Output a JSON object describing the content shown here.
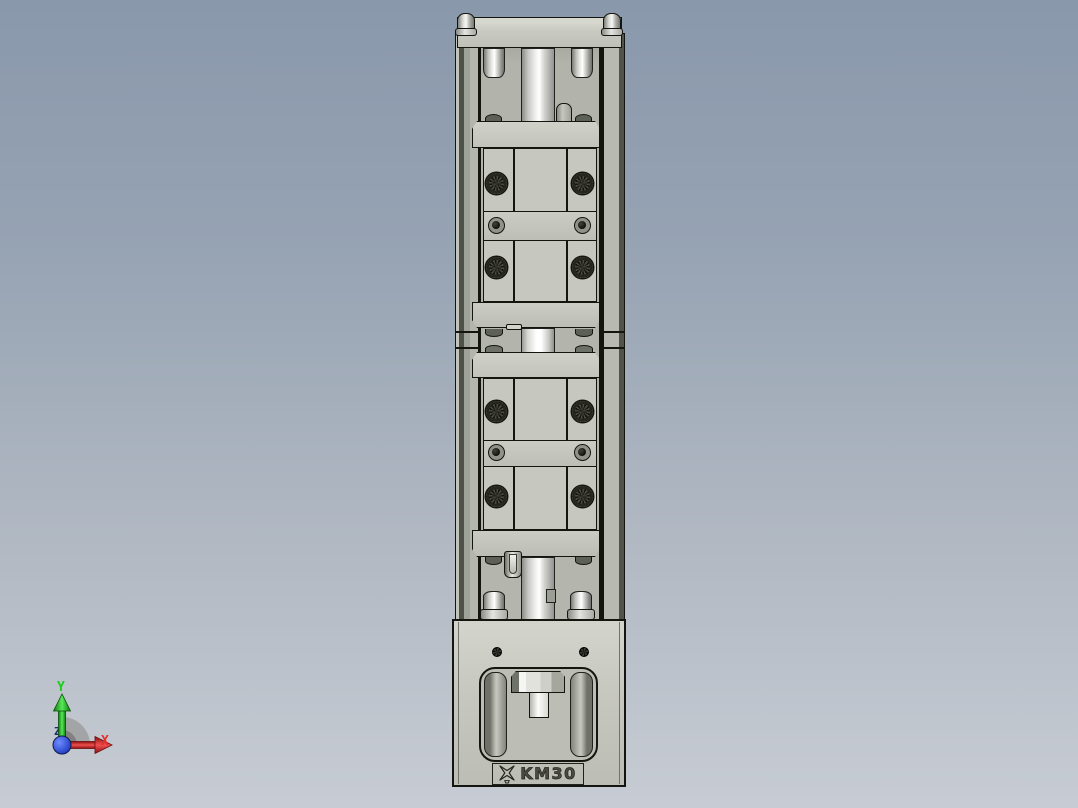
{
  "viewport": {
    "type": "3d-cad-view",
    "background_gradient_top": "#8A98AC",
    "background_gradient_bottom": "#C7CCD4"
  },
  "triad": {
    "y_label": "Y",
    "x_label": "X",
    "z_label": "Z",
    "y_color": "#17CF17",
    "x_color": "#E3302C",
    "z_color": "#1C2C6E",
    "origin_sphere_color": "#1C38C4",
    "arc_color": "#9E9E9E"
  },
  "model": {
    "part_label": "KM30",
    "brand_logo": "pinwheel-x-logo",
    "view": "front",
    "body_color": "#C6C7BF",
    "edge_color": "#15150F",
    "metal_highlight_color": "#F4F4F0",
    "side_wall_dark_color": "#50534A",
    "carriage_count": 2,
    "torx_screws_per_carriage": 4,
    "socket_screws_per_carriage": 2
  }
}
